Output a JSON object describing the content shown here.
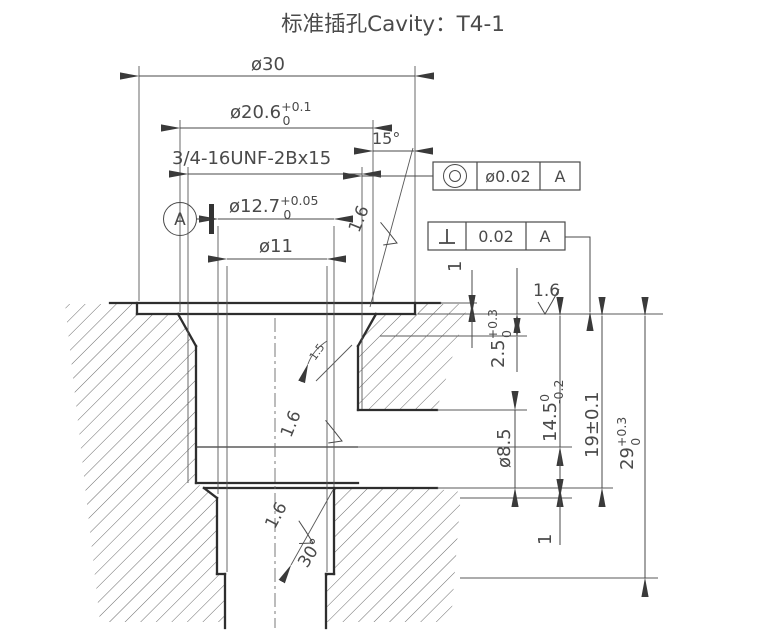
{
  "title": "标准插孔Cavity：T4-1",
  "dims": {
    "d30": "ø30",
    "d206": {
      "base": "ø20.6",
      "sup": "+0.1",
      "sub": "0"
    },
    "thread": "3/4-16UNF-2Bx15",
    "angle15": "15°",
    "d127": {
      "base": "ø12.7",
      "sup": "+0.05",
      "sub": "0"
    },
    "d11": "ø11",
    "t1_top": "1",
    "t25": {
      "base": "2.5",
      "sup": "+0.3",
      "sub": "0"
    },
    "t145": {
      "base": "14.5",
      "sup": "0",
      "sub": "-0.2"
    },
    "t19": "19±0.1",
    "t29": {
      "base": "29",
      "sup": "+0.3",
      "sub": "0"
    },
    "d85": "ø8.5",
    "t1_bot": "1",
    "angle30": "30°",
    "note": "1.5"
  },
  "datum": {
    "label": "A"
  },
  "finish": {
    "value": "1.6"
  },
  "gdt": {
    "concentricity": {
      "tolerance": "ø0.02",
      "datum": "A"
    },
    "perpendicularity": {
      "tolerance": "0.02",
      "datum": "A"
    }
  },
  "colors": {
    "line": "#2e2e2e",
    "thin_line": "#585858",
    "text": "#4a4a4a",
    "background": "#ffffff"
  }
}
